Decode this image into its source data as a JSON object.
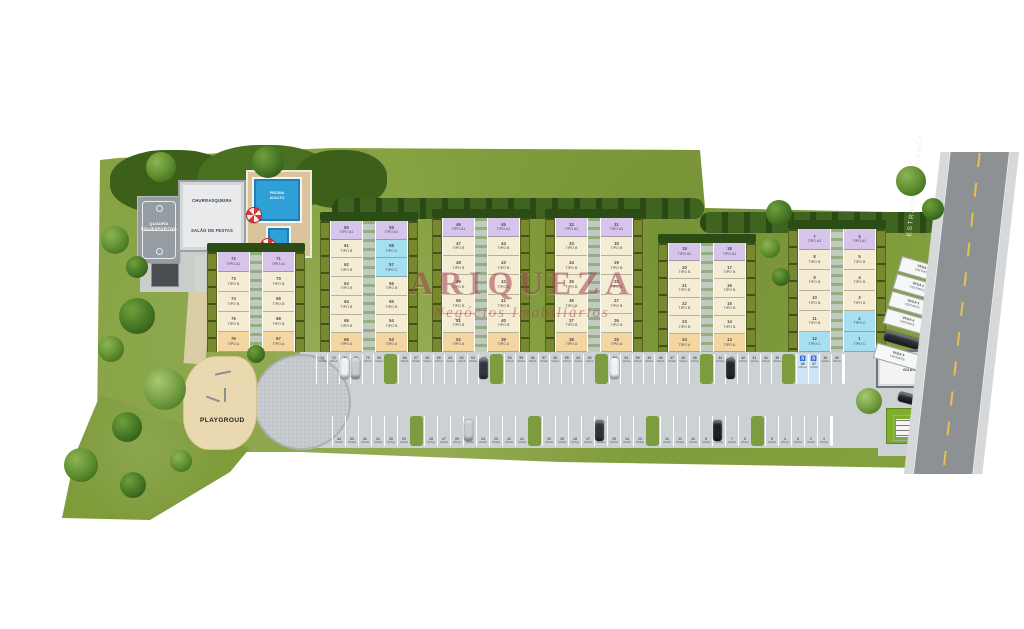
{
  "watermark": {
    "title": "ARIQUEZA",
    "subtitle": "Negócios Imobiliários",
    "color": "#a04350"
  },
  "amenities": {
    "court_line1": "QUADRA",
    "court_line2": "POLIESPORTIVA",
    "bbq": "CHURRASQUEIRA",
    "party_hall": "SALÃO DE FESTAS",
    "pool_line1": "PISCINA",
    "pool_line2": "ADULTO",
    "playground": "PLAYGROUD",
    "guard_house": "GUARITA"
  },
  "road": {
    "name": "ESTRADA DA BONANÇA"
  },
  "tipo_word": "TIPO",
  "tipo_colors": {
    "A1": "#d6c4ea",
    "B": "#f4edd3",
    "A": "#f3d6a2",
    "C": "#a6dff0"
  },
  "blocks": [
    {
      "id": "block-6",
      "x": 207,
      "y": 252,
      "h": 100,
      "floors": [
        {
          "left": {
            "num": "72",
            "tipo": "A1"
          },
          "right": {
            "num": "71",
            "tipo": "A1"
          }
        },
        {
          "left": {
            "num": "73",
            "tipo": "B"
          },
          "right": {
            "num": "70",
            "tipo": "B"
          }
        },
        {
          "left": {
            "num": "74",
            "tipo": "B"
          },
          "right": {
            "num": "69",
            "tipo": "B"
          }
        },
        {
          "left": {
            "num": "75",
            "tipo": "B"
          },
          "right": {
            "num": "68",
            "tipo": "B"
          }
        },
        {
          "left": {
            "num": "76",
            "tipo": "A"
          },
          "right": {
            "num": "67",
            "tipo": "A"
          }
        }
      ]
    },
    {
      "id": "block-5",
      "x": 320,
      "y": 221,
      "h": 131,
      "floors": [
        {
          "left": {
            "num": "60",
            "tipo": "A1"
          },
          "right": {
            "num": "59",
            "tipo": "A1"
          }
        },
        {
          "left": {
            "num": "61",
            "tipo": "B"
          },
          "right": {
            "num": "58",
            "tipo": "C"
          }
        },
        {
          "left": {
            "num": "62",
            "tipo": "B"
          },
          "right": {
            "num": "57",
            "tipo": "C"
          }
        },
        {
          "left": {
            "num": "63",
            "tipo": "B"
          },
          "right": {
            "num": "56",
            "tipo": "B"
          }
        },
        {
          "left": {
            "num": "64",
            "tipo": "B"
          },
          "right": {
            "num": "55",
            "tipo": "B"
          }
        },
        {
          "left": {
            "num": "65",
            "tipo": "B"
          },
          "right": {
            "num": "54",
            "tipo": "B"
          }
        },
        {
          "left": {
            "num": "66",
            "tipo": "A"
          },
          "right": {
            "num": "53",
            "tipo": "A"
          }
        }
      ]
    },
    {
      "id": "block-4",
      "x": 432,
      "y": 218,
      "h": 134,
      "floors": [
        {
          "left": {
            "num": "46",
            "tipo": "A1"
          },
          "right": {
            "num": "45",
            "tipo": "A1"
          }
        },
        {
          "left": {
            "num": "47",
            "tipo": "B"
          },
          "right": {
            "num": "44",
            "tipo": "B"
          }
        },
        {
          "left": {
            "num": "48",
            "tipo": "B"
          },
          "right": {
            "num": "43",
            "tipo": "B"
          }
        },
        {
          "left": {
            "num": "49",
            "tipo": "B"
          },
          "right": {
            "num": "42",
            "tipo": "B"
          }
        },
        {
          "left": {
            "num": "50",
            "tipo": "B"
          },
          "right": {
            "num": "41",
            "tipo": "B"
          }
        },
        {
          "left": {
            "num": "51",
            "tipo": "B"
          },
          "right": {
            "num": "40",
            "tipo": "B"
          }
        },
        {
          "left": {
            "num": "52",
            "tipo": "A"
          },
          "right": {
            "num": "39",
            "tipo": "A"
          }
        }
      ]
    },
    {
      "id": "block-3",
      "x": 545,
      "y": 218,
      "h": 134,
      "floors": [
        {
          "left": {
            "num": "32",
            "tipo": "A1"
          },
          "right": {
            "num": "31",
            "tipo": "A1"
          }
        },
        {
          "left": {
            "num": "33",
            "tipo": "B"
          },
          "right": {
            "num": "30",
            "tipo": "B"
          }
        },
        {
          "left": {
            "num": "34",
            "tipo": "B"
          },
          "right": {
            "num": "29",
            "tipo": "B"
          }
        },
        {
          "left": {
            "num": "35",
            "tipo": "B"
          },
          "right": {
            "num": "28",
            "tipo": "B"
          }
        },
        {
          "left": {
            "num": "36",
            "tipo": "B"
          },
          "right": {
            "num": "27",
            "tipo": "B"
          }
        },
        {
          "left": {
            "num": "37",
            "tipo": "B"
          },
          "right": {
            "num": "26",
            "tipo": "B"
          }
        },
        {
          "left": {
            "num": "38",
            "tipo": "A"
          },
          "right": {
            "num": "25",
            "tipo": "A"
          }
        }
      ]
    },
    {
      "id": "block-2",
      "x": 658,
      "y": 243,
      "h": 109,
      "floors": [
        {
          "left": {
            "num": "19",
            "tipo": "A1"
          },
          "right": {
            "num": "18",
            "tipo": "A1"
          }
        },
        {
          "left": {
            "num": "20",
            "tipo": "B"
          },
          "right": {
            "num": "17",
            "tipo": "B"
          }
        },
        {
          "left": {
            "num": "21",
            "tipo": "B"
          },
          "right": {
            "num": "16",
            "tipo": "B"
          }
        },
        {
          "left": {
            "num": "22",
            "tipo": "B"
          },
          "right": {
            "num": "15",
            "tipo": "B"
          }
        },
        {
          "left": {
            "num": "23",
            "tipo": "B"
          },
          "right": {
            "num": "14",
            "tipo": "B"
          }
        },
        {
          "left": {
            "num": "24",
            "tipo": "A"
          },
          "right": {
            "num": "13",
            "tipo": "A"
          }
        }
      ]
    },
    {
      "id": "block-1",
      "x": 788,
      "y": 229,
      "h": 123,
      "floors": [
        {
          "left": {
            "num": "7",
            "tipo": "A1"
          },
          "right": {
            "num": "6",
            "tipo": "A1"
          }
        },
        {
          "left": {
            "num": "8",
            "tipo": "B"
          },
          "right": {
            "num": "5",
            "tipo": "B"
          }
        },
        {
          "left": {
            "num": "9",
            "tipo": "B"
          },
          "right": {
            "num": "4",
            "tipo": "B"
          }
        },
        {
          "left": {
            "num": "10",
            "tipo": "B"
          },
          "right": {
            "num": "3",
            "tipo": "B"
          }
        },
        {
          "left": {
            "num": "11",
            "tipo": "B"
          },
          "right": {
            "num": "2",
            "tipo": "C"
          }
        },
        {
          "left": {
            "num": "12",
            "tipo": "C"
          },
          "right": {
            "num": "1",
            "tipo": "C"
          }
        }
      ]
    }
  ],
  "parking": {
    "label_word": "VAGA",
    "handicap_symbol": "♿",
    "top_row": [
      74,
      73,
      72,
      71,
      70,
      69,
      68,
      67,
      66,
      65,
      64,
      63,
      62,
      61,
      60,
      59,
      58,
      57,
      56,
      55,
      54,
      53,
      52,
      51,
      50,
      49,
      48,
      47,
      46,
      45,
      44,
      43,
      42,
      41,
      40,
      39,
      38,
      37,
      36,
      35
    ],
    "bottom_row": [
      34,
      33,
      32,
      31,
      30,
      29,
      28,
      27,
      26,
      25,
      24,
      23,
      22,
      21,
      20,
      19,
      18,
      17,
      16,
      15,
      14,
      13,
      12,
      11,
      10,
      9,
      8,
      7,
      6,
      5,
      4,
      3,
      2,
      1
    ],
    "islands_top": [
      6,
      14,
      22,
      30,
      36
    ],
    "islands_bottom": [
      6,
      14,
      22,
      29
    ],
    "handicap_top": [
      36,
      37
    ],
    "cars_top": [
      {
        "i": 2,
        "c": "#eef0f2"
      },
      {
        "i": 3,
        "c": "#c8ccd1"
      },
      {
        "i": 13,
        "c": "#33373d"
      },
      {
        "i": 22,
        "c": "#f0f1f3"
      },
      {
        "i": 31,
        "c": "#24272c"
      }
    ],
    "cars_bottom": [
      {
        "i": 9,
        "c": "#c8ccd1"
      },
      {
        "i": 18,
        "c": "#2f3338"
      },
      {
        "i": 26,
        "c": "#1d2126"
      }
    ]
  },
  "visitor": {
    "slots": [
      {
        "type": "label",
        "l1": "VAGA 1",
        "l2": "VISITANTE"
      },
      {
        "type": "label",
        "l1": "VAGA 2",
        "l2": "VISITANTE"
      },
      {
        "type": "label",
        "l1": "VAGA 3",
        "l2": "VISITANTE"
      },
      {
        "type": "label",
        "l1": "VAGA 4",
        "l2": "VISITANTE"
      },
      {
        "type": "car"
      },
      {
        "type": "label",
        "l1": "VAGA 5",
        "l2": "VISITANTE"
      }
    ]
  }
}
